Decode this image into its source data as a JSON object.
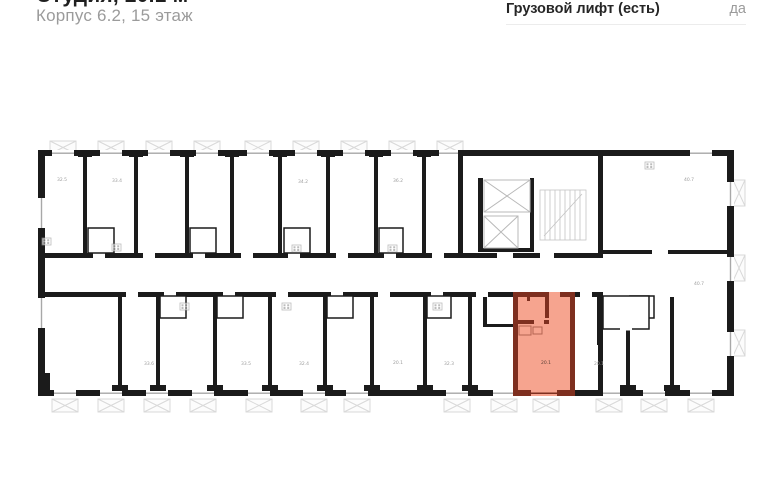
{
  "header": {
    "title": "Студия, 20.1 м²",
    "subtitle": "Корпус 6.2, 15 этаж"
  },
  "details": {
    "freight_elevator_label": "Грузовой лифт (есть)",
    "freight_elevator_value": "да"
  },
  "plan": {
    "highlighted_unit": {
      "area_label": "20.1"
    },
    "room_areas": {
      "t1": "32.5",
      "t2": "33.4",
      "t3": "34.2",
      "t4": "36.2",
      "rt": "40.7",
      "b1": "33.6",
      "b2": "33.5",
      "b3": "32.4",
      "b4": "20.1",
      "b5": "32.3",
      "hl": "20.1",
      "b6": "20.1",
      "rb": "40.7"
    }
  },
  "colors": {
    "highlight_fill": "#F6A48F",
    "highlight_wall": "#7E2F1F",
    "wall": "#1B1B1B",
    "muted_text": "#9B9B9B",
    "balcony_line": "#D9D9D9",
    "divider": "#ECECEC",
    "title_text": "#1F1F1F"
  }
}
